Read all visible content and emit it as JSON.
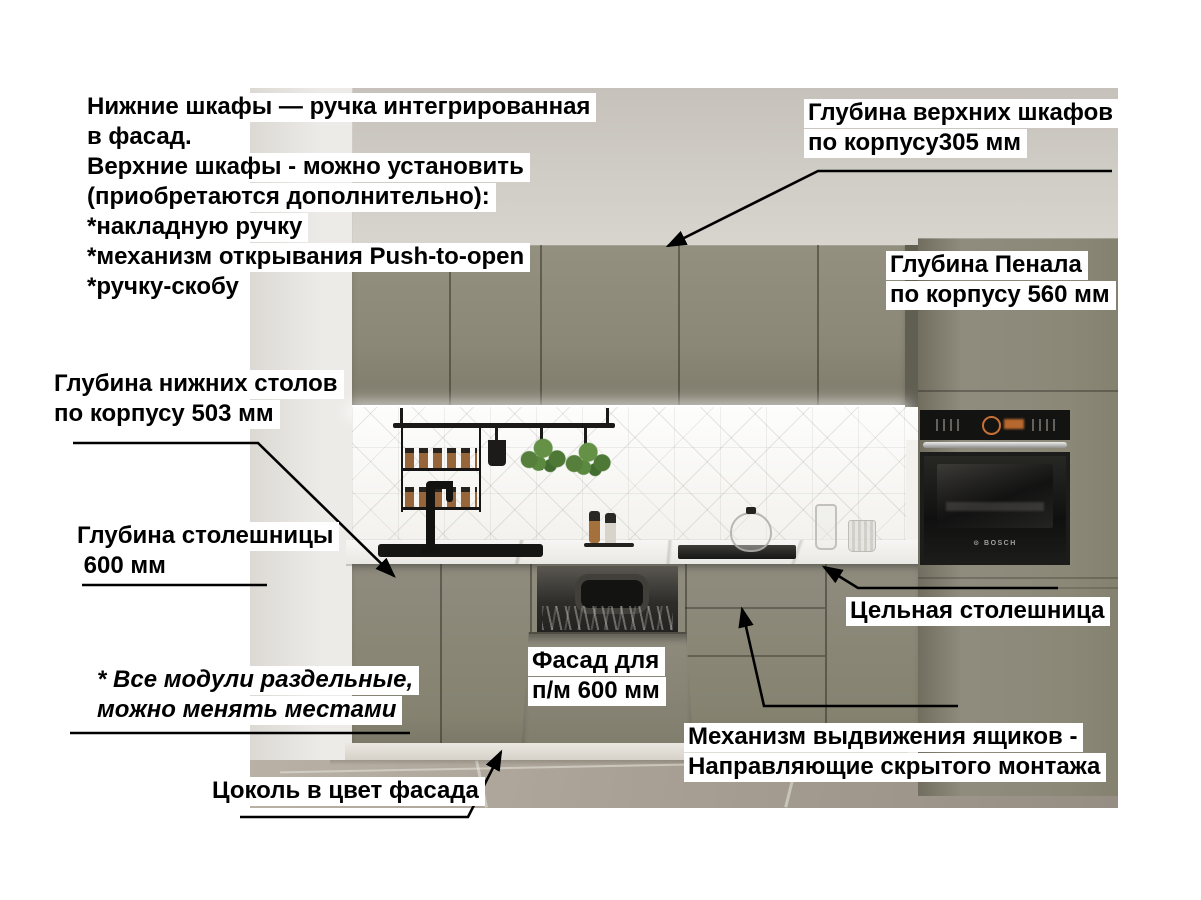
{
  "annotations": {
    "handles_note": {
      "lines": [
        "Нижние шкафы — ручка интегрированная",
        "в фасад.",
        "Верхние шкафы - можно установить",
        "(приобретаются дополнительно):",
        "*накладную ручку",
        "*механизм открывания Push-to-open",
        "*ручку-скобу"
      ]
    },
    "upper_cabinet_depth": {
      "lines": [
        "Глубина верхних шкафов",
        "по корпусу305 мм"
      ]
    },
    "tall_cabinet_depth": {
      "lines": [
        "Глубина Пенала",
        "по корпусу 560 мм"
      ]
    },
    "base_cabinet_depth": {
      "lines": [
        "Глубина нижних столов",
        "по корпусу 503 мм"
      ]
    },
    "countertop_depth": {
      "lines": [
        "Глубина столешницы",
        " 600 мм"
      ]
    },
    "modules_note": {
      "lines": [
        "* Все модули раздельные,",
        "можно менять местами"
      ]
    },
    "plinth_note": {
      "text": "Цоколь в цвет фасада"
    },
    "dishwasher_facade": {
      "lines": [
        "Фасад для",
        "п/м 600 мм"
      ]
    },
    "solid_countertop": {
      "text": "Цельная столешница"
    },
    "drawer_mechanism": {
      "lines": [
        "Механизм выдвижения ящиков -",
        "Направляющие скрытого монтажа"
      ]
    }
  },
  "scene": {
    "oven_brand": "BOSCH"
  },
  "colors": {
    "cabinet": "#8b8878",
    "wallTop": "#c6c2bb",
    "wallLight": "#e9e7e3",
    "backsplash": "#fafaf8",
    "counter": "#eae8e4",
    "plinth": "#d6d2c9",
    "floorB": "#968e83",
    "ovenOrange": "#dd7b35",
    "annotation_text": "#000000",
    "annotation_bg": "#ffffff"
  }
}
